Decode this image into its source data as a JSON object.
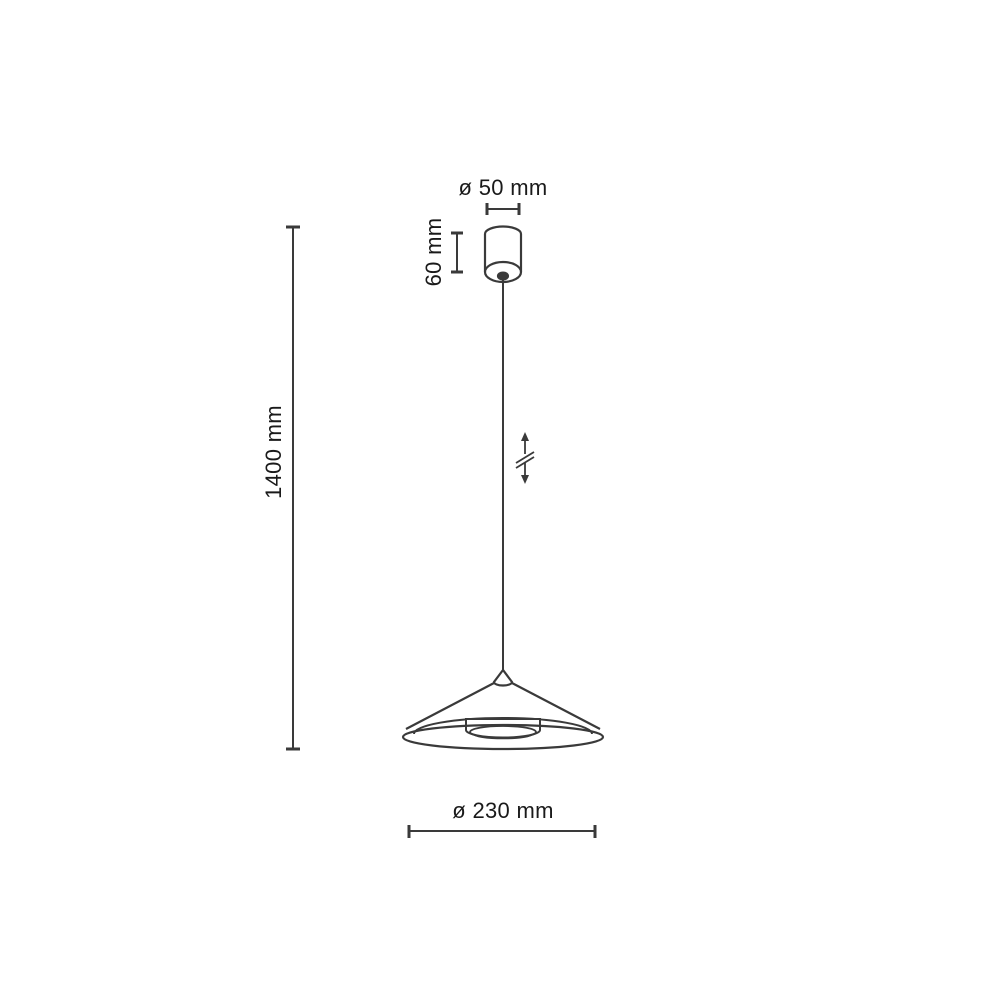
{
  "diagram": {
    "kind": "pendant-lamp-dimension-drawing",
    "colors": {
      "line": "#3a3a3a",
      "text": "#1a1a1a",
      "background": "#ffffff"
    },
    "dimensions": {
      "canopy_diameter_label": "ø 50 mm",
      "canopy_height_label": "60 mm",
      "suspension_height_label": "1400 mm",
      "shade_diameter_label": "ø 230 mm"
    },
    "icons": {
      "height_adjustable": "vertical double arrow with break slashes"
    }
  }
}
